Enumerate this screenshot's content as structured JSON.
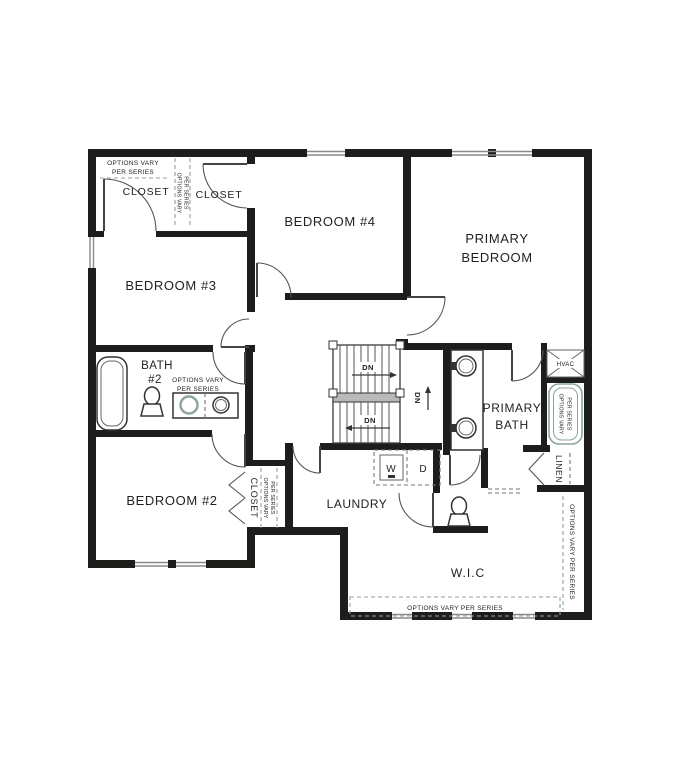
{
  "floor_plan": {
    "rooms": {
      "bedroom_2": "BEDROOM #2",
      "bedroom_3": "BEDROOM #3",
      "bedroom_4": "BEDROOM #4",
      "primary_bedroom_line1": "PRIMARY",
      "primary_bedroom_line2": "BEDROOM",
      "primary_bath_line1": "PRIMARY",
      "primary_bath_line2": "BATH",
      "bath_2_line1": "BATH",
      "bath_2_line2": "#2",
      "laundry": "LAUNDRY",
      "wic": "W.I.C",
      "closet": "CLOSET",
      "linen": "LINEN",
      "hvac": "HVAC"
    },
    "annotations": {
      "options_vary_line1": "OPTIONS VARY",
      "options_vary_line2": "PER SERIES",
      "options_vary_full": "OPTIONS VARY PER SERIES",
      "down": "DN",
      "washer": "W",
      "dryer": "D"
    },
    "colors": {
      "wall": "#1d1d1b",
      "annotation_teal": "#8ba59a"
    }
  }
}
